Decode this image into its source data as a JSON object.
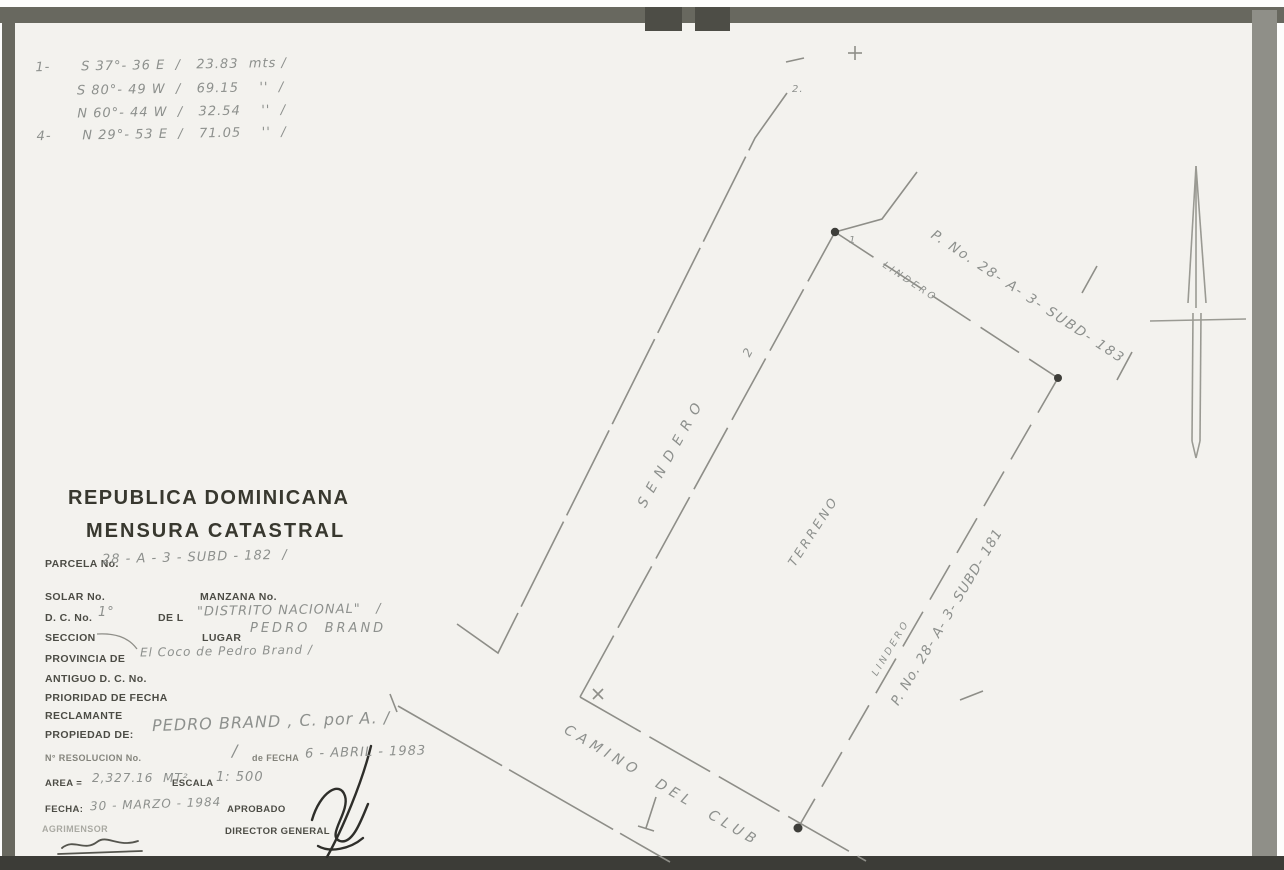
{
  "doc": {
    "title_line1": "REPUBLICA DOMINICANA",
    "title_line2": "MENSURA CATASTRAL"
  },
  "bearings": {
    "rows": [
      "1-      S 37°- 36 E  /   23.83  mts /",
      "        S 80°- 49 W  /   69.15    ''  /",
      "        N 60°- 44 W  /   32.54    ''  /",
      "4-      N 29°- 53 E  /   71.05    ''  /"
    ]
  },
  "form": {
    "parcela_label": "PARCELA No.",
    "parcela_value": "28 - A - 3 - SUBD - 182  /",
    "solar_label": "SOLAR No.",
    "manzana_label": "MANZANA No.",
    "dc_label": "D. C. No.",
    "dc_value": "1°",
    "dc_de_label": "DE L",
    "dc_place_value": "\"DISTRITO NACIONAL\"   /",
    "seccion_label": "SECCION",
    "lugar_label": "LUGAR",
    "lugar_value": "PEDRO  BRAND",
    "provincia_label": "PROVINCIA DE",
    "provincia_value": "El Coco de Pedro Brand /",
    "antiguo_label": "ANTIGUO D. C. No.",
    "prioridad_label": "PRIORIDAD DE FECHA",
    "reclamante_label": "RECLAMANTE",
    "propiedad_label": "PROPIEDAD DE:",
    "propiedad_value": "PEDRO BRAND , C. por A. /",
    "resolucion_label": "N° RESOLUCION No.",
    "resolucion_value": "/",
    "fecha_res_label": "de FECHA",
    "fecha_res_value": "6 - ABRIL - 1983",
    "area_label": "AREA =",
    "area_value": "2,327.16  MT²",
    "escala_label": "ESCALA",
    "escala_value": "1: 500",
    "fecha_label": "FECHA:",
    "fecha_value": "30 - MARZO - 1984",
    "aprobado_label": "APROBADO",
    "agrimensor_label": "AGRIMENSOR",
    "director_label": "DIRECTOR GENERAL"
  },
  "map": {
    "sendero_label": "SENDERO",
    "sendero_mark": "2",
    "lindero_top_label": "LINDERO",
    "parcel_top_label": "P. No. 28- A- 3- SUBD- 183",
    "lindero_right_label": "LINDERO",
    "parcel_right_label": "P. No. 28- A- 3- SUBD- 181",
    "terreno_label": "TERRENO",
    "camino_label": "CAMINO  DEL  CLUB",
    "corner_mark_north": "1",
    "corner_mark_top": "2.",
    "plus_mark": "+",
    "dash_mark": "—"
  },
  "colors": {
    "page": "#f3f2ee",
    "frame": "#68685f",
    "ink": "#4c4c45",
    "handwriting": "#8d908d",
    "drawing_line": "#8e8e88"
  }
}
